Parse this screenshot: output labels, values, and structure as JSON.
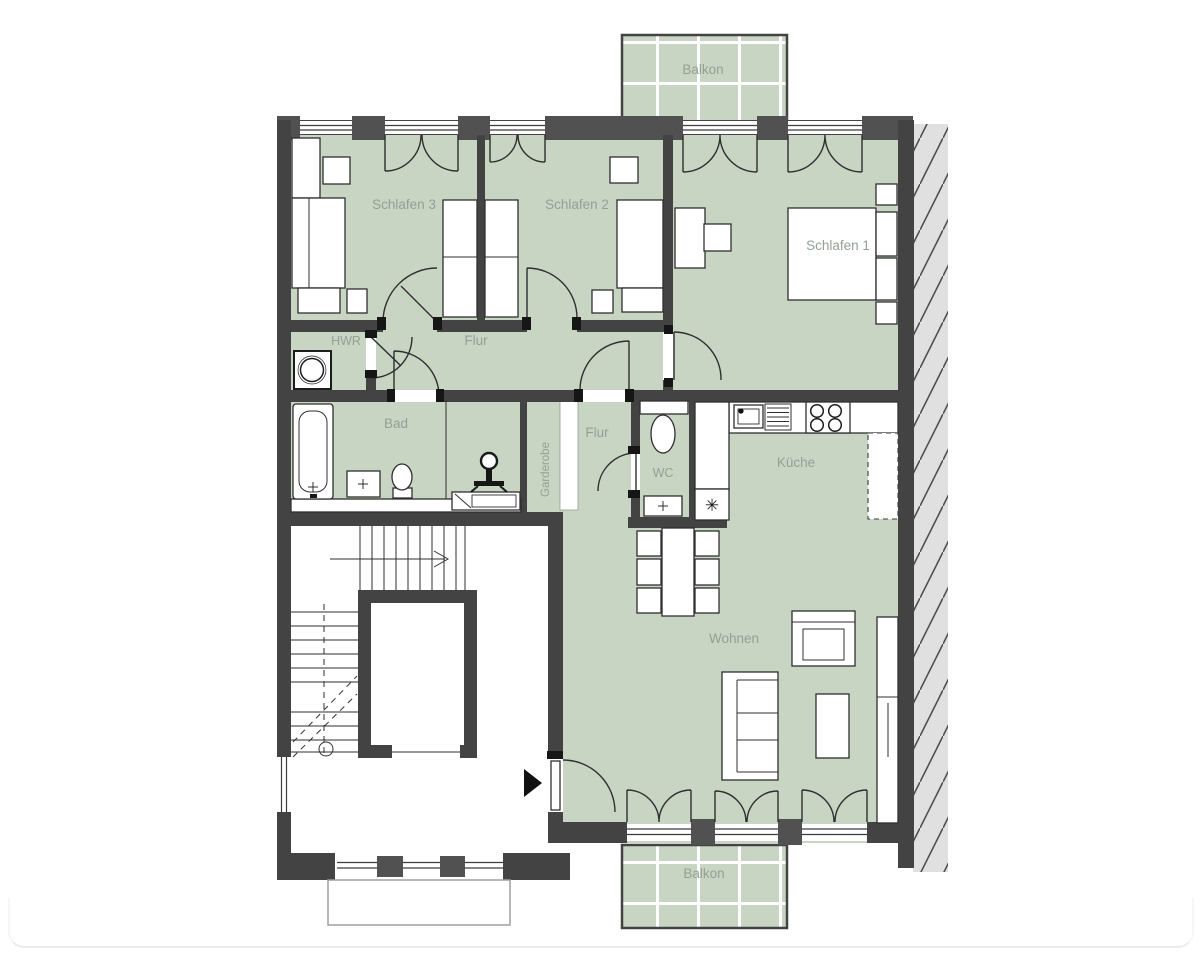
{
  "title": "Wohnung Grundriss",
  "colors": {
    "room": "#c8d5c3",
    "wall": "#434343",
    "pillar": "#515151",
    "line": "#2f2f2f",
    "label": "#93a093",
    "hatch_bg": "#e0e0e0",
    "hatch_line": "#4f4f4f",
    "balcony_grid": "#ffffff",
    "stoop": "#9f9f9f",
    "page_edge": "#ececec"
  },
  "rooms": {
    "balkon_top": {
      "label": "Balkon"
    },
    "schlafen3": {
      "label": "Schlafen 3"
    },
    "schlafen2": {
      "label": "Schlafen 2"
    },
    "schlafen1": {
      "label": "Schlafen 1"
    },
    "hwr": {
      "label": "HWR"
    },
    "flur": {
      "label": "Flur"
    },
    "bad": {
      "label": "Bad"
    },
    "garderobe": {
      "label": "Garderobe"
    },
    "flur2": {
      "label": "Flur"
    },
    "wc": {
      "label": "WC"
    },
    "kueche": {
      "label": "Küche"
    },
    "wohnen": {
      "label": "Wohnen"
    },
    "balkon_bottom": {
      "label": "Balkon"
    }
  },
  "icons": {
    "appliance_marker": "✳",
    "entrance_arrow": "entrance-direction-arrow",
    "stairs_arrow": "stairs-direction-arrow"
  }
}
